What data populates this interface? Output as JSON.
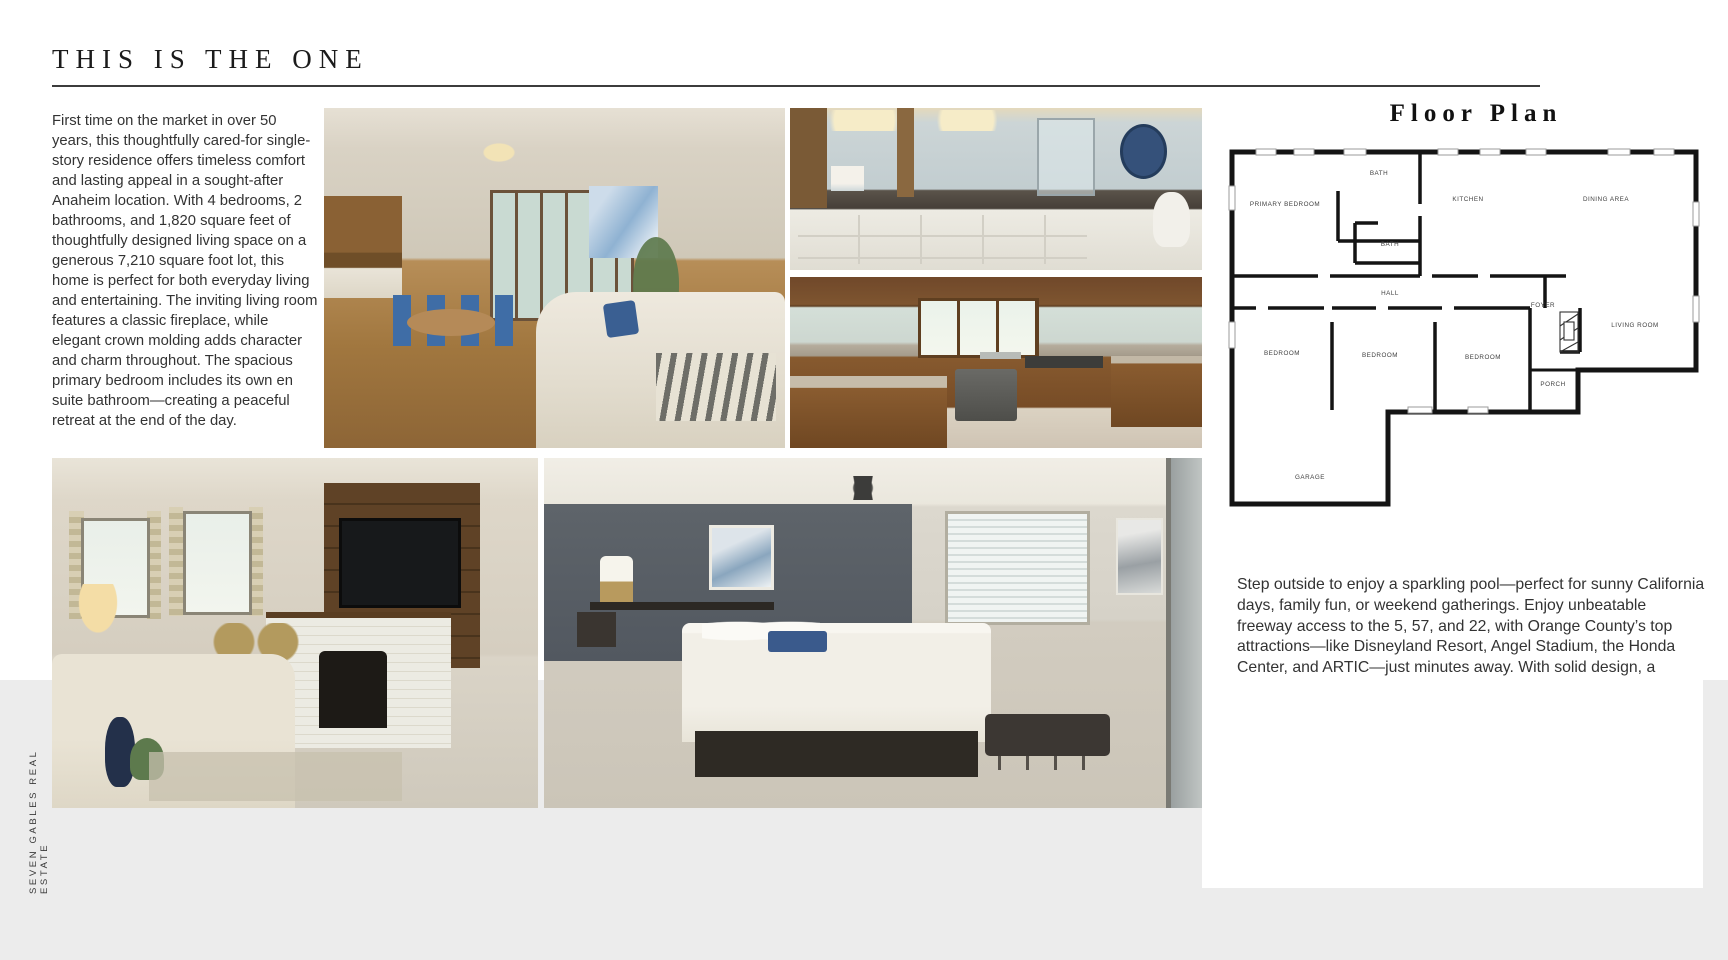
{
  "page": {
    "title": "THIS IS THE ONE",
    "brand_vertical": "SEVEN GABLES REAL ESTATE"
  },
  "intro": {
    "paragraph": "First time on the market in over 50 years, this thoughtfully cared-for single-story residence offers timeless comfort and lasting appeal in a sought-after Anaheim location. With 4 bedrooms, 2 bathrooms, and 1,820 square feet of thoughtfully designed living space on a generous 7,210 square foot lot, this home is perfect for both everyday living and entertaining. The inviting living room features a classic fireplace, while elegant crown molding adds character and charm throughout. The spacious primary bedroom includes its own en suite bathroom—creating a peaceful retreat at the end of the day."
  },
  "floor_plan": {
    "title": "Floor Plan",
    "rooms": [
      "PRIMARY BEDROOM",
      "BATH",
      "KITCHEN",
      "DINING AREA",
      "BATH",
      "HALL",
      "FOYER",
      "LIVING ROOM",
      "BEDROOM",
      "BEDROOM",
      "BEDROOM",
      "PORCH",
      "GARAGE"
    ]
  },
  "details": {
    "paragraph": "Step outside to enjoy a sparkling pool—perfect for sunny California days, family fun, or weekend gatherings. Enjoy unbeatable freeway access to the 5, 57, and 22, with Orange County’s top attractions—like Disneyland Resort, Angel Stadium, the Honda Center, and ARTIC—just minutes away. With solid design, a welcoming layout, and a location that can't be beat, 2623 E Norm Pl is a rare opportunity to create your next chapter in the heart of Anaheim.",
    "stats": [
      {
        "value": "4",
        "icon": "bed-icon"
      },
      {
        "value": "2",
        "icon": "bathtub-icon"
      },
      {
        "value": "1,820",
        "icon": "area-ruler-icon"
      }
    ],
    "offered_at": "OFFERED AT $1,100,000"
  },
  "photos": [
    {
      "name": "living-dining-room"
    },
    {
      "name": "bathroom"
    },
    {
      "name": "kitchen"
    },
    {
      "name": "family-room-fireplace"
    },
    {
      "name": "primary-bedroom"
    }
  ]
}
